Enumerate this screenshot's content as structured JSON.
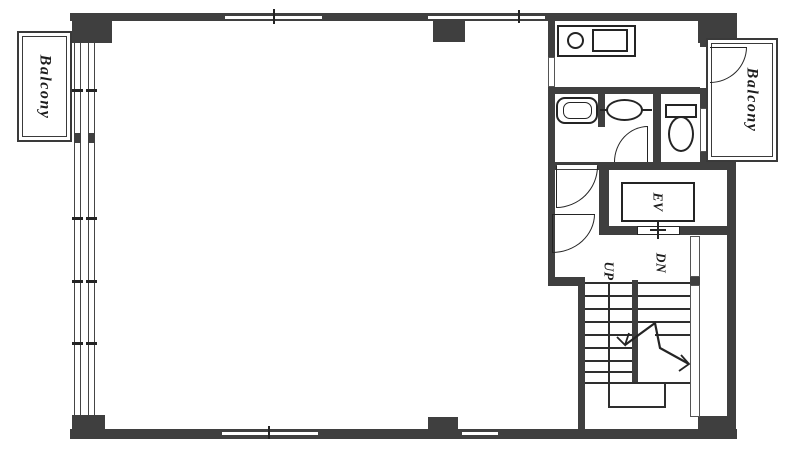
{
  "labels": {
    "balcony_left": "Balcony",
    "balcony_right": "Balcony",
    "elevator": "EV",
    "stairs_up": "UP",
    "stairs_down": "DN"
  },
  "colors": {
    "wall": "#3f3f3f",
    "line": "#242424",
    "window_fill": "#ffffff",
    "background": "#ffffff"
  }
}
